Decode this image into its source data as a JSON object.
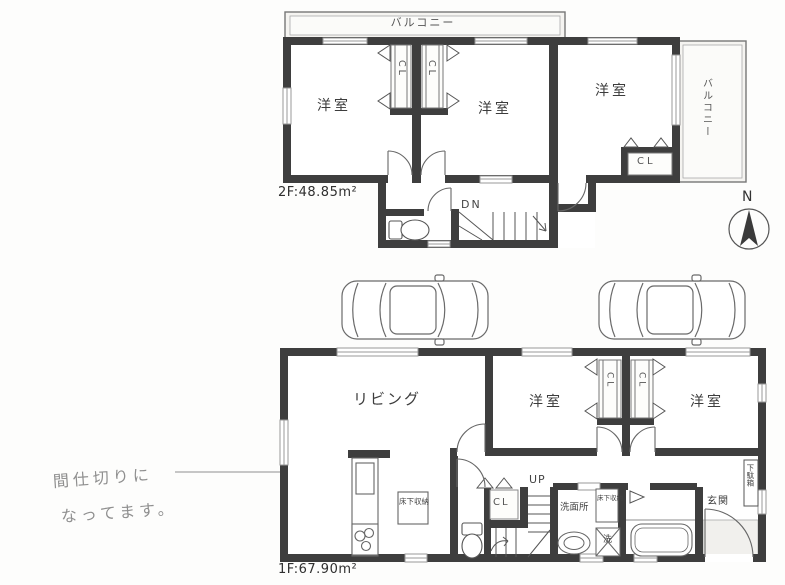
{
  "colors": {
    "wall": "#3e3e3e",
    "thin_line": "#666666",
    "balcony_fill": "#f5f4f1",
    "genkan_fill": "#f1f0ed",
    "pencil_note": "#8f8f8f"
  },
  "compass": {
    "north_label": "N"
  },
  "floor2": {
    "area_label": "2F:48.85m²",
    "balcony_top": "バルコニー",
    "balcony_right": "バルコニー",
    "rooms": [
      "洋室",
      "洋室",
      "洋室"
    ],
    "closets": [
      "CL",
      "CL",
      "CL"
    ],
    "stair_label": "DN"
  },
  "floor1": {
    "area_label": "1F:67.90m²",
    "living": "リビング",
    "rooms": [
      "洋室",
      "洋室"
    ],
    "closets": [
      "CL",
      "CL",
      "CL"
    ],
    "stair_label": "UP",
    "washroom": "洗面所",
    "underfloor_storage": [
      "床下収納",
      "床下収納"
    ],
    "laundry": "洗",
    "entrance": "玄関",
    "shoe_cabinet": "下駄箱"
  },
  "annotation": {
    "line1": "間仕切りに",
    "line2": "なってます。"
  }
}
